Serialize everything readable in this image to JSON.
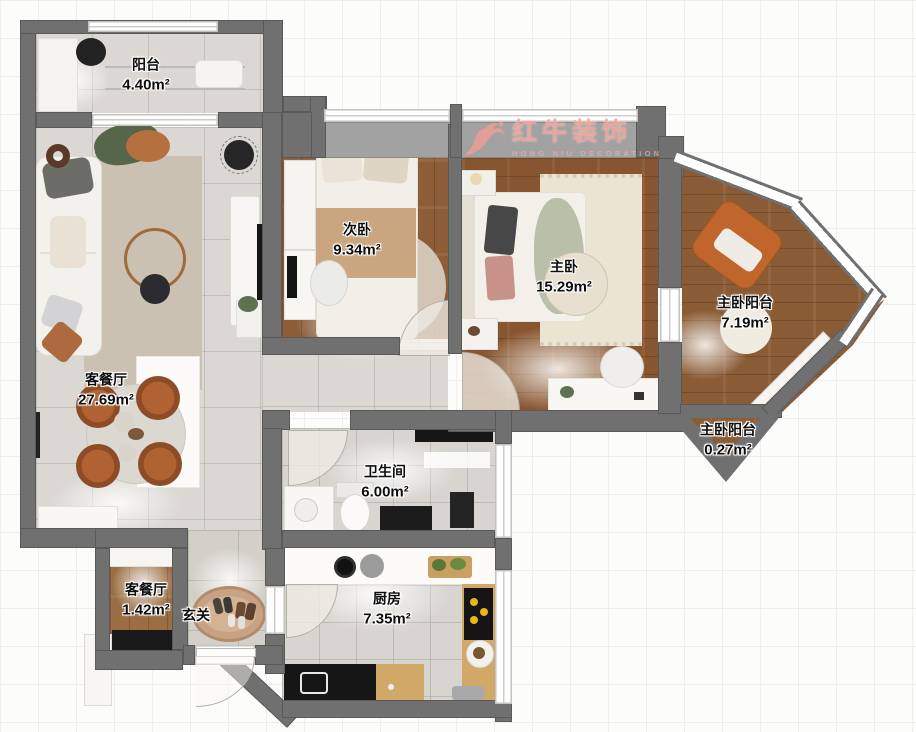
{
  "watermark": {
    "brand": "红牛装饰",
    "subtitle": "HONG NIU DECORATION"
  },
  "rooms": {
    "balcony": {
      "name": "阳台",
      "area": "4.40m²"
    },
    "living": {
      "name": "客餐厅",
      "area": "27.69m²"
    },
    "second_bedroom": {
      "name": "次卧",
      "area": "9.34m²"
    },
    "master_bedroom": {
      "name": "主卧",
      "area": "15.29m²"
    },
    "master_balcony": {
      "name": "主卧阳台",
      "area": "7.19m²"
    },
    "master_balcony_small": {
      "name": "主卧阳台",
      "area": "0.27m²"
    },
    "bathroom": {
      "name": "卫生间",
      "area": "6.00m²"
    },
    "dining_small": {
      "name": "客餐厅",
      "area": "1.42m²"
    },
    "hallway": {
      "name": "玄关"
    },
    "kitchen": {
      "name": "厨房",
      "area": "7.35m²"
    }
  },
  "colors": {
    "wall": "#707070",
    "tile": "#dbd8d3",
    "wood_master": "#87552f",
    "wood_second": "#8d5d38",
    "wood_balcony": "#8a5c36",
    "watermark_red": "#f39e94",
    "chair_rust": "#a85c30"
  }
}
